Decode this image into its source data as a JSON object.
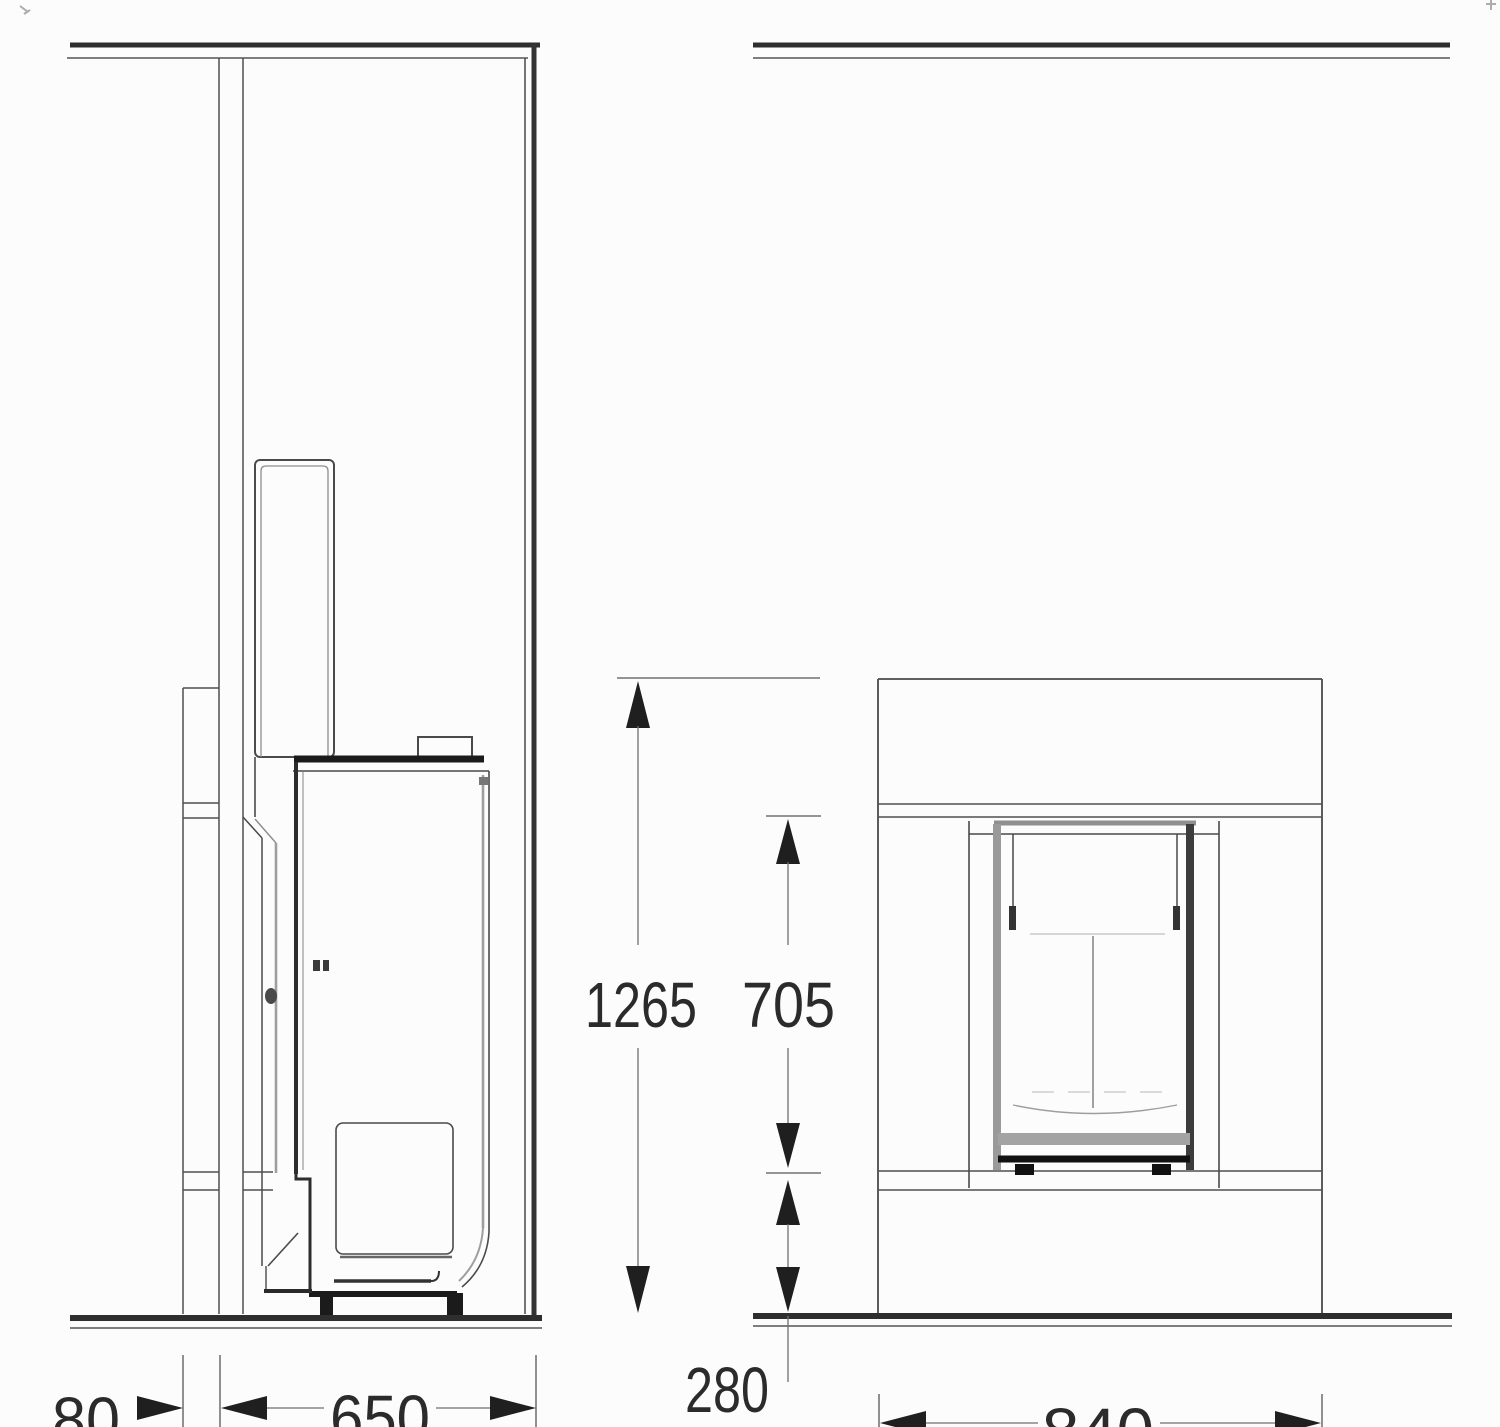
{
  "drawing": {
    "colors": {
      "background": "#fcfcfc",
      "line_thin": "#4f4f4f",
      "line_thick": "#1f1f1f",
      "line_gray": "#9e9e9e",
      "text": "#2b2b2b"
    },
    "side_view": {
      "dims": {
        "wall_gap": "80",
        "depth": "650"
      }
    },
    "front_view": {
      "dims": {
        "height_total": "1265",
        "height_opening": "705",
        "height_plinth": "280",
        "width": "840"
      }
    }
  }
}
